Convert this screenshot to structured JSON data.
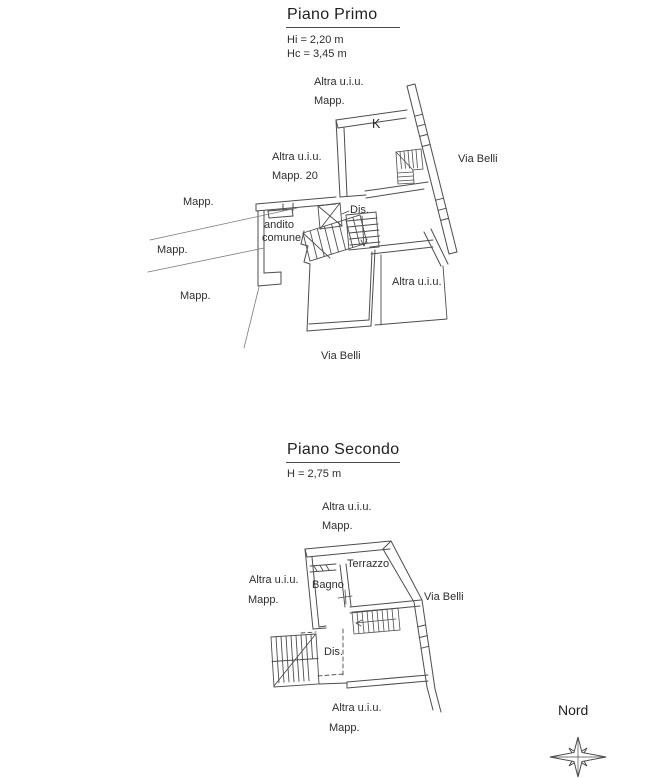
{
  "page": {
    "background": "#ffffff",
    "line_color": "#4d4d4d",
    "thin_line_color": "#7a7a7a",
    "text_color": "#2e2e2e"
  },
  "floor1": {
    "title": "Piano Primo",
    "height_line1": "Hi = 2,20 m",
    "height_line2": "Hc = 3,45 m",
    "labels": {
      "top_altra": "Altra u.i.u.",
      "top_mapp": "Mapp.",
      "room_k": "K",
      "via_belli_right": "Via Belli",
      "left_altra": "Altra u.i.u.",
      "left_mapp20": "Mapp. 20",
      "mapp_upper": "Mapp.",
      "dis": "Dis.",
      "andito_line1": "andito",
      "andito_line2": "comune",
      "mapp_middle": "Mapp.",
      "right_altra": "Altra u.i.u.",
      "mapp_lower": "Mapp.",
      "via_belli_bottom": "Via Belli"
    }
  },
  "floor2": {
    "title": "Piano Secondo",
    "height_line1": "H = 2,75 m",
    "labels": {
      "top_altra": "Altra u.i.u.",
      "top_mapp": "Mapp.",
      "terrazzo": "Terrazzo",
      "bagno": "Bagno",
      "left_altra": "Altra u.i.u.",
      "left_mapp": "Mapp.",
      "via_belli": "Via Belli",
      "dis": "Dis.",
      "bottom_altra": "Altra u.i.u.",
      "bottom_mapp": "Mapp."
    }
  },
  "compass": {
    "label": "Nord"
  }
}
